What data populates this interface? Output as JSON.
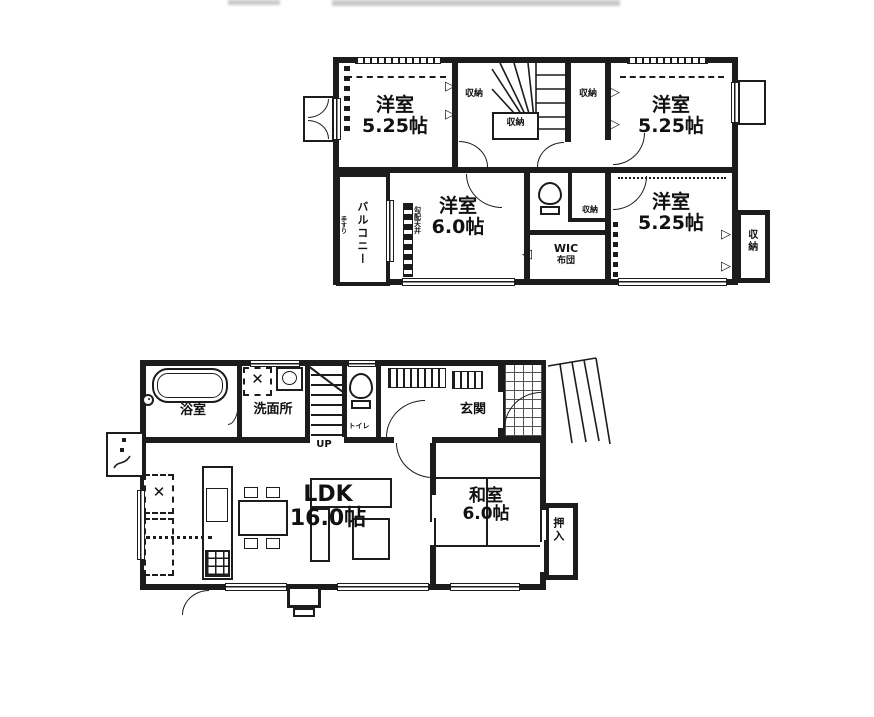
{
  "colors": {
    "ink": "#1c1c1c",
    "paper": "#ffffff"
  },
  "icons": {
    "cross": "✕",
    "tri_right": "▷",
    "tri_left": "◁"
  },
  "floor2": {
    "bedroom_nw": {
      "name": "洋室",
      "size": "5.25帖"
    },
    "bedroom_ne": {
      "name": "洋室",
      "size": "5.25帖"
    },
    "bedroom_center": {
      "name": "洋室",
      "size": "6.0帖"
    },
    "bedroom_se": {
      "name": "洋室",
      "size": "5.25帖"
    },
    "balcony_label": "バルコニー",
    "balcony_note": "手すり",
    "closet_nw": "収納",
    "closet_under_stairs": "収納",
    "closet_ne": "収納",
    "closet_hall": "収納",
    "closet_east": "収納",
    "wic_label": "WIC",
    "wic_sub": "布団",
    "slope_note": "勾配天井"
  },
  "floor1": {
    "bath": "浴室",
    "washroom": "洗面所",
    "toilet": "トイレ",
    "entrance": "玄関",
    "stairs_up": "UP",
    "ldk": {
      "name": "LDK",
      "size": "16.0帖"
    },
    "washitsu": {
      "name": "和室",
      "size": "6.0帖"
    },
    "oshiire": "押入"
  }
}
